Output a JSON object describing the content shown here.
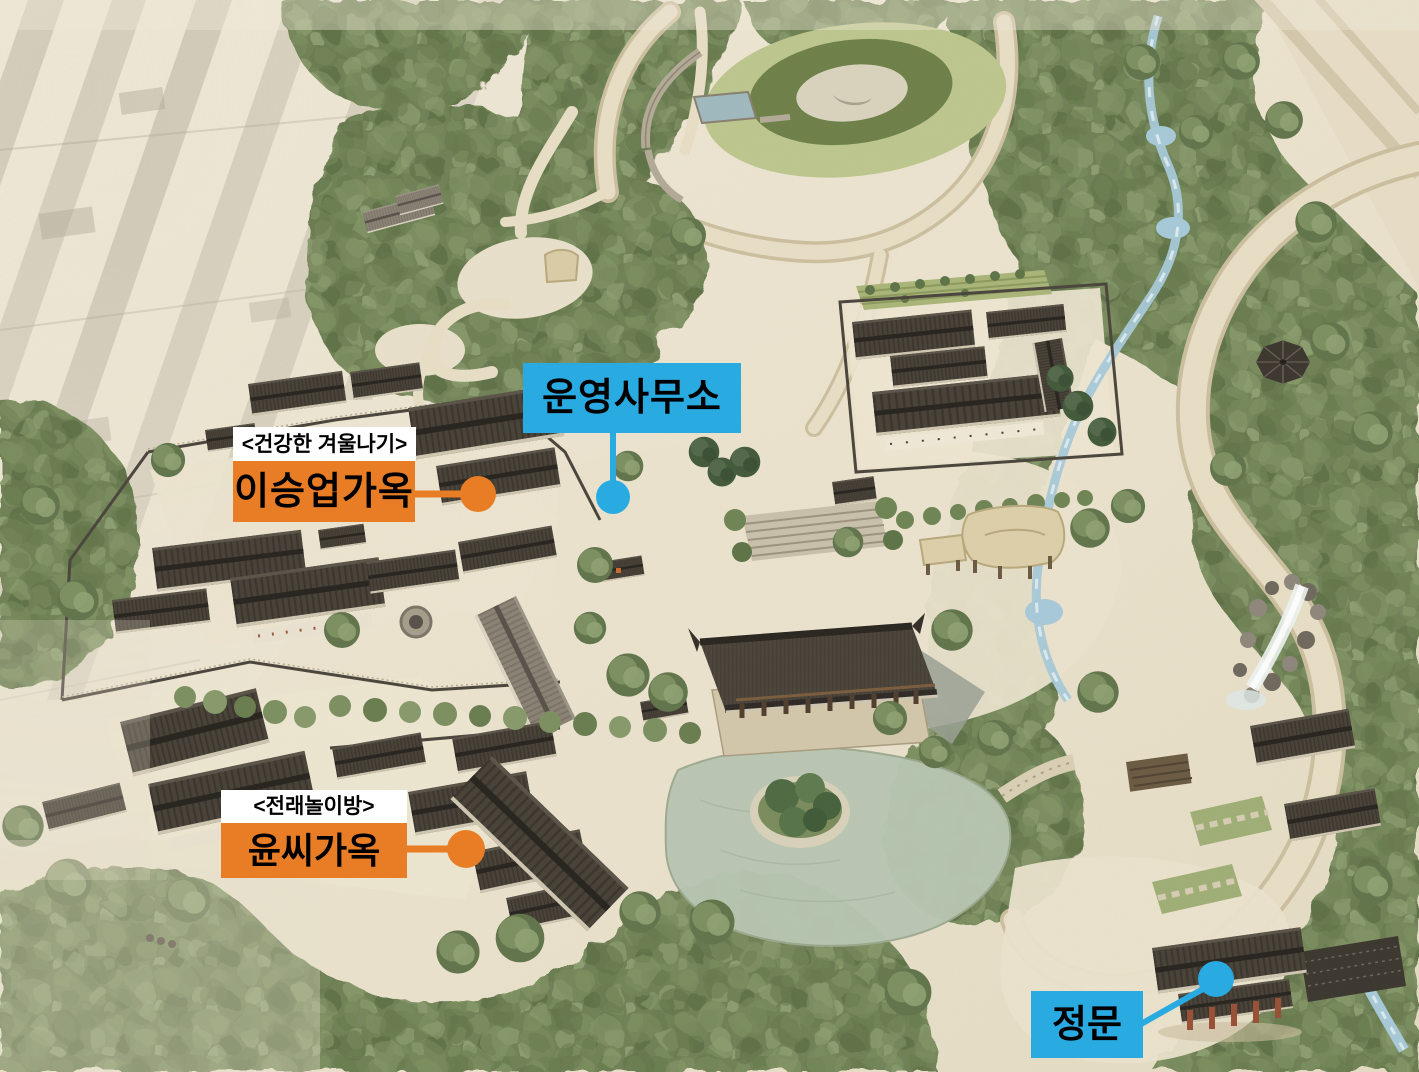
{
  "callouts": {
    "operations_office": {
      "label": "운영사무소",
      "color": "#29ABE2"
    },
    "lee_seungup_house": {
      "tag": "<건강한 겨울나기>",
      "label": "이승업가옥",
      "color": "#E87D26"
    },
    "yoon_family_house": {
      "tag": "<전래놀이방>",
      "label": "윤씨가옥",
      "color": "#E87D26"
    },
    "main_gate": {
      "label": "정문",
      "color": "#29ABE2"
    }
  },
  "palette": {
    "callout_blue": "#29ABE2",
    "callout_orange": "#E87D26",
    "callout_tag_background": "#FFFFFF",
    "callout_text": "#000000",
    "paper": "#EBE3CF",
    "forest_green": "#6F8156",
    "lawn_light": "#BCC68D",
    "lawn_dark": "#6E8049",
    "water": "#A7C9D8",
    "pond": "#B7C6B1",
    "roof_dark": "#474137",
    "roof_light": "#8A8375"
  }
}
